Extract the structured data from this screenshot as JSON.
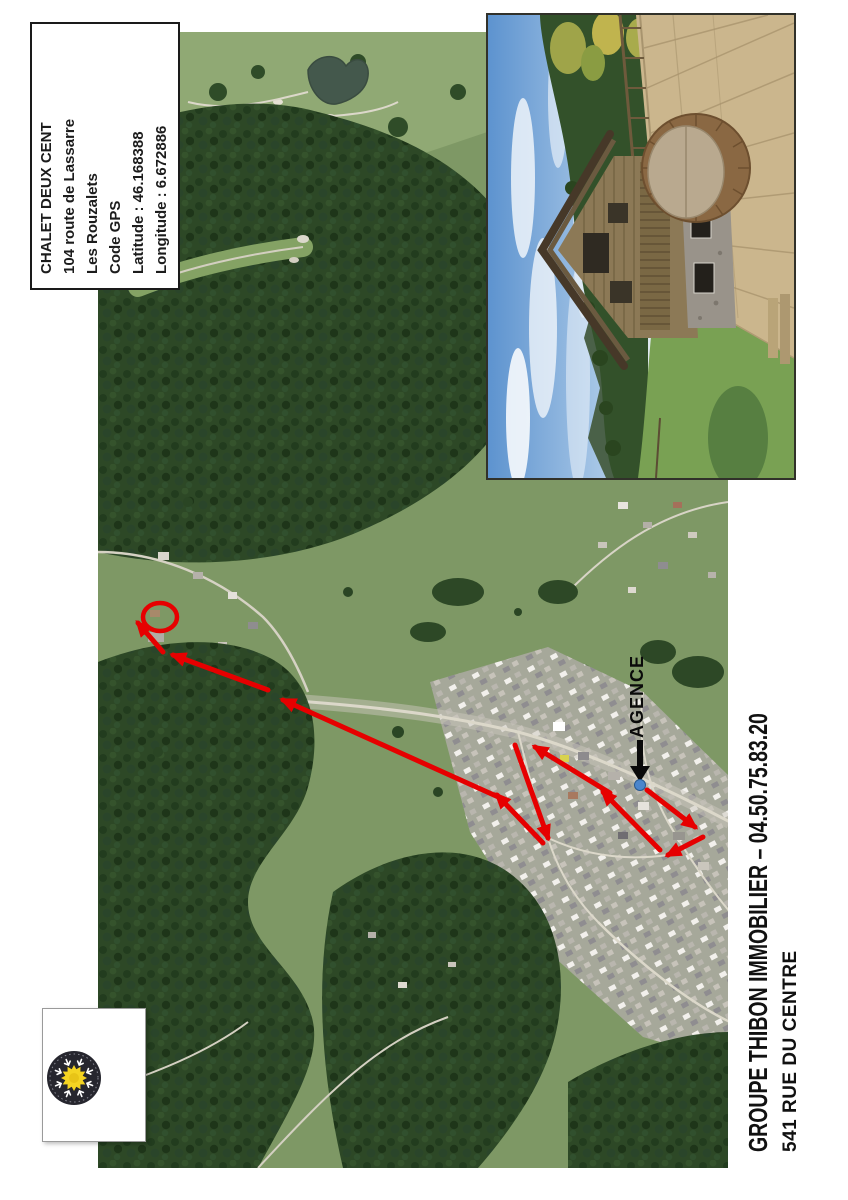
{
  "info_box": {
    "lines": [
      "CHALET DEUX CENT",
      "104 route de Lassarre",
      "Les Rouzalets",
      "Code GPS",
      "Latitude : 46.168388",
      "Longitude : 6.672886"
    ]
  },
  "map": {
    "agence_label": "AGENCE",
    "route_color": "#e60000",
    "annotation_color": "#0a0a0a",
    "agency_dot_color": "#4b86cc"
  },
  "footer": {
    "line1": "GROUPE THIBON IMMOBILIER – 04.50.75.83.20",
    "line2": "541 RUE DU CENTRE"
  },
  "logo": {
    "title": "Les Gets",
    "subtitle": "Portes du Soleil",
    "sun_color": "#f4d422",
    "emblem_color": "#26262e"
  }
}
